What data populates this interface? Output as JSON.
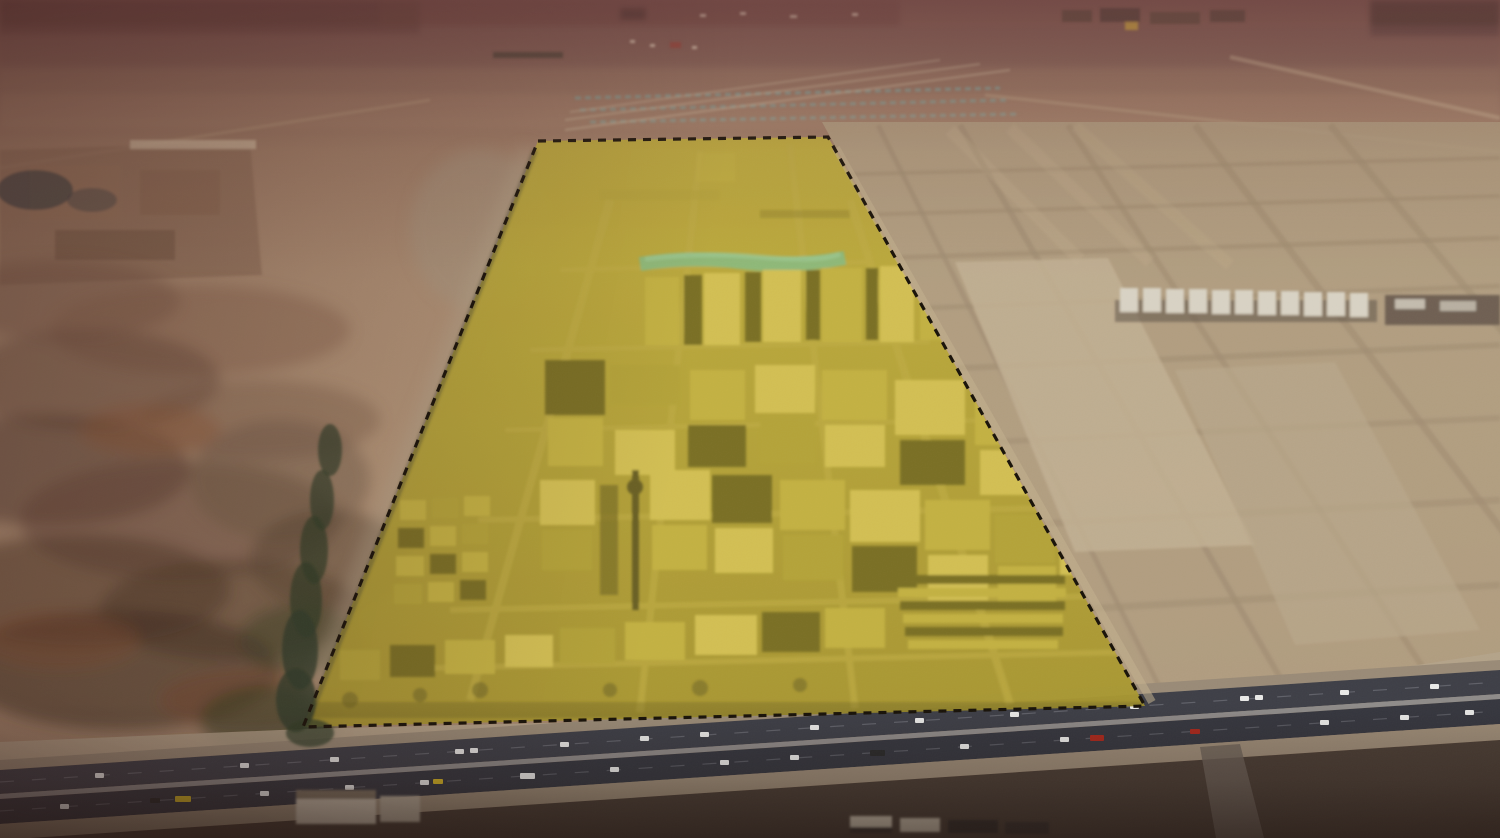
{
  "scene": {
    "type": "aerial-photograph",
    "subject": "Oblique aerial photograph of a desert industrial district; one large land parcel is highlighted with a translucent yellow overlay and a black dashed boundary, bordered by a multi-lane highway in the foreground and vacant gridded lots to the right",
    "site_overlay": {
      "points": "538,141 828,137 1145,706 303,727",
      "border_style": "dashed",
      "fill_color": "#c2ad2e",
      "border_color": "#181208"
    },
    "highway": {
      "carriageways": 2,
      "orientation": "horizontal, rising slightly to the right"
    },
    "regions": [
      {
        "name": "hazy-horizon",
        "description": "mauve-brown dusty haze band across the top"
      },
      {
        "name": "distant-settlement",
        "description": "tiny distant buildings and a housing development with teal plot rows above the site"
      },
      {
        "name": "scrub-terrain-left",
        "description": "mottled dark brown and rust desert scrubland"
      },
      {
        "name": "vacant-lot-grid-right",
        "description": "subdivided empty desert parcels with dirt roads and a row of white warehouses"
      },
      {
        "name": "highlighted-industrial-site",
        "description": "industrial yards and gabled warehouses under the yellow overlay, with a dark minaret tower and a teal roof strip"
      },
      {
        "name": "highway-foreground",
        "description": "dual-carriageway highway with light traffic"
      }
    ],
    "colors": {
      "haze_top": "#6b4a40",
      "haze_mauve": "#7c5a54",
      "desert_distant": "#a98a6e",
      "desert_mid": "#b29478",
      "desert_light": "#c2a988",
      "terrain_dark": "#5f4737",
      "terrain_rust": "#91592f",
      "vegetation_dark": "#31402a",
      "lot_light": "#c2b194",
      "grid_road": "#a08d72",
      "warehouse_white": "#d9d3c5",
      "warehouse_dark": "#6f6052",
      "site_fill": "#c2ad2e",
      "site_border": "#181208",
      "roof_bright": "#d8c65e",
      "roof_mid": "#c4b348",
      "roof_dull": "#b0a13c",
      "roof_shadow": "#655d24",
      "site_dark": "#4f4a20",
      "street_olive": "#c0ae4e",
      "teal_strip": "#74c19e",
      "frontage": "#b5a48c",
      "shoulder": "#9a8b77",
      "asphalt_1": "#3e3f47",
      "asphalt_2": "#36373f",
      "median": "#8a8a8c",
      "below_road": "#4b3e35",
      "vehicle_white": "#e9e9e7",
      "vehicle_yellow": "#d4b426",
      "vehicle_red": "#a8291d",
      "vehicle_dark": "#2b2b2b"
    }
  }
}
